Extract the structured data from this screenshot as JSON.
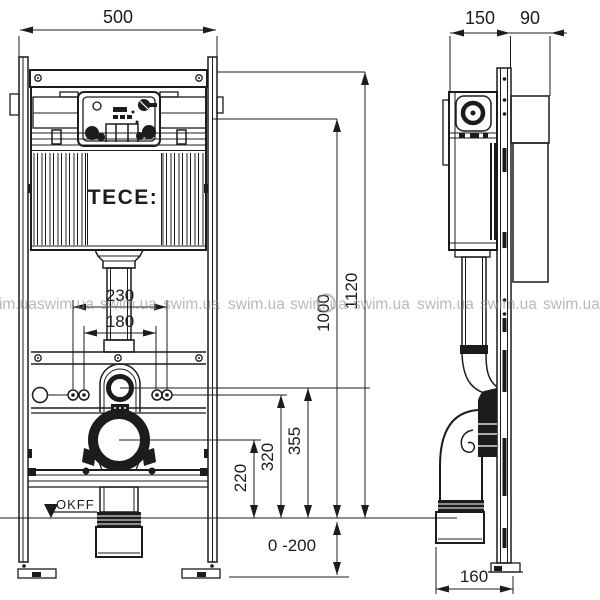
{
  "watermark": {
    "text": "swim.ua"
  },
  "brand": {
    "label": "TECE:"
  },
  "annotations": {
    "floor_level": "OKFF",
    "leg_adjustment_range": "0 -200"
  },
  "dimensions_front": {
    "overall_width": "500",
    "flush_pipe_width": "230",
    "fixing_bolt_spacing": "180",
    "drain_outlet_height": "220",
    "fixing_bolt_height": "320",
    "water_connection_height": "355",
    "flush_unit_height": "1000",
    "overall_height": "1120"
  },
  "dimensions_side": {
    "frame_depth": "150",
    "wall_bracket_depth": "90",
    "drain_outlet_offset": "160"
  },
  "colors": {
    "line": "#1c1c1c",
    "watermark": "#8f8f8f",
    "background": "#ffffff"
  }
}
